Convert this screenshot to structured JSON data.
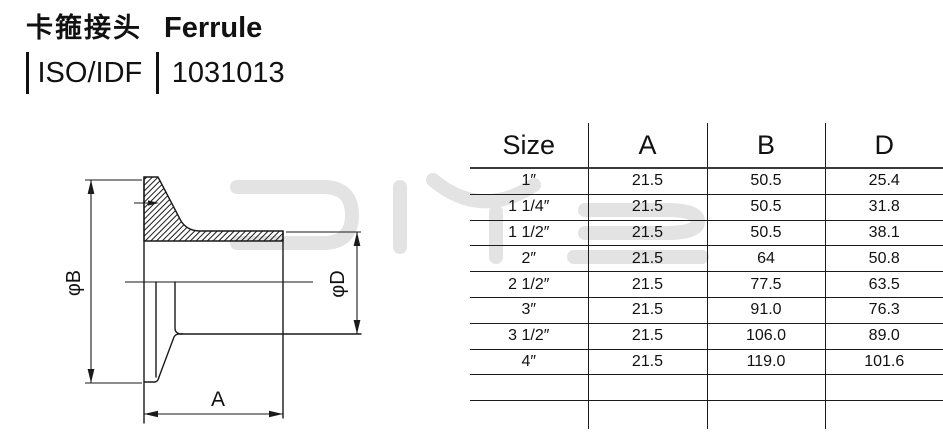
{
  "header": {
    "title_cn": "卡箍接头",
    "title_en": "Ferrule",
    "standard": "ISO/IDF",
    "part_number": "1031013"
  },
  "watermark": {
    "text": "DIYE",
    "color": "#e3e3e3"
  },
  "drawing": {
    "labels": {
      "diameter_b": "φB",
      "diameter_d": "φD",
      "length_a": "A"
    }
  },
  "table": {
    "columns": [
      "Size",
      "A",
      "B",
      "D"
    ],
    "rows": [
      [
        "1″",
        "21.5",
        "50.5",
        "25.4"
      ],
      [
        "1 1/4″",
        "21.5",
        "50.5",
        "31.8"
      ],
      [
        "1 1/2″",
        "21.5",
        "50.5",
        "38.1"
      ],
      [
        "2″",
        "21.5",
        "64",
        "50.8"
      ],
      [
        "2 1/2″",
        "21.5",
        "77.5",
        "63.5"
      ],
      [
        "3″",
        "21.5",
        "91.0",
        "76.3"
      ],
      [
        "3 1/2″",
        "21.5",
        "106.0",
        "89.0"
      ],
      [
        "4″",
        "21.5",
        "119.0",
        "101.6"
      ]
    ],
    "empty_rows": 2
  },
  "colors": {
    "line": "#1a1a1a",
    "background": "#ffffff",
    "watermark": "#e3e3e3"
  }
}
